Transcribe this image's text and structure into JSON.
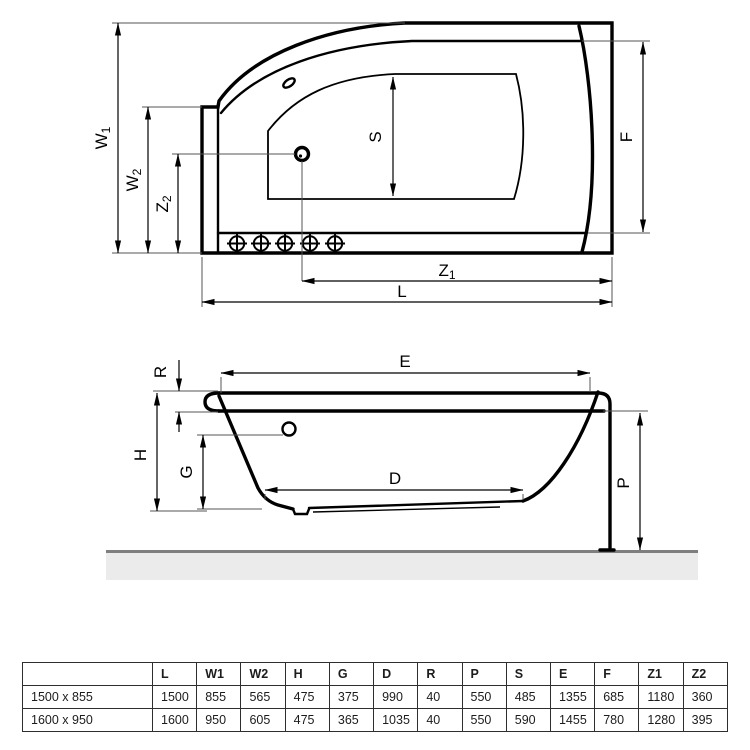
{
  "diagram": {
    "labels": {
      "W1": {
        "base": "W",
        "sub": "1"
      },
      "W2": {
        "base": "W",
        "sub": "2"
      },
      "Z1": {
        "base": "Z",
        "sub": "1"
      },
      "Z2": {
        "base": "Z",
        "sub": "2"
      },
      "L": "L",
      "S": "S",
      "F": "F",
      "E": "E",
      "R": "R",
      "H": "H",
      "G": "G",
      "D": "D",
      "P": "P"
    },
    "icons": [
      "faucet-hole",
      "overflow-hole",
      "jet-nozzle"
    ],
    "colors": {
      "line": "#000000",
      "extension_line": "#555555",
      "floor_fill": "#ebebeb",
      "floor_edge": "#7f7f7f",
      "table_border": "#2e2e2e"
    }
  },
  "table": {
    "headers": [
      "",
      "L",
      "W1",
      "W2",
      "H",
      "G",
      "D",
      "R",
      "P",
      "S",
      "E",
      "F",
      "Z1",
      "Z2"
    ],
    "rows": [
      [
        "1500 x 855",
        "1500",
        "855",
        "565",
        "475",
        "375",
        "990",
        "40",
        "550",
        "485",
        "1355",
        "685",
        "1180",
        "360"
      ],
      [
        "1600 x 950",
        "1600",
        "950",
        "605",
        "475",
        "365",
        "1035",
        "40",
        "550",
        "590",
        "1455",
        "780",
        "1280",
        "395"
      ]
    ]
  }
}
